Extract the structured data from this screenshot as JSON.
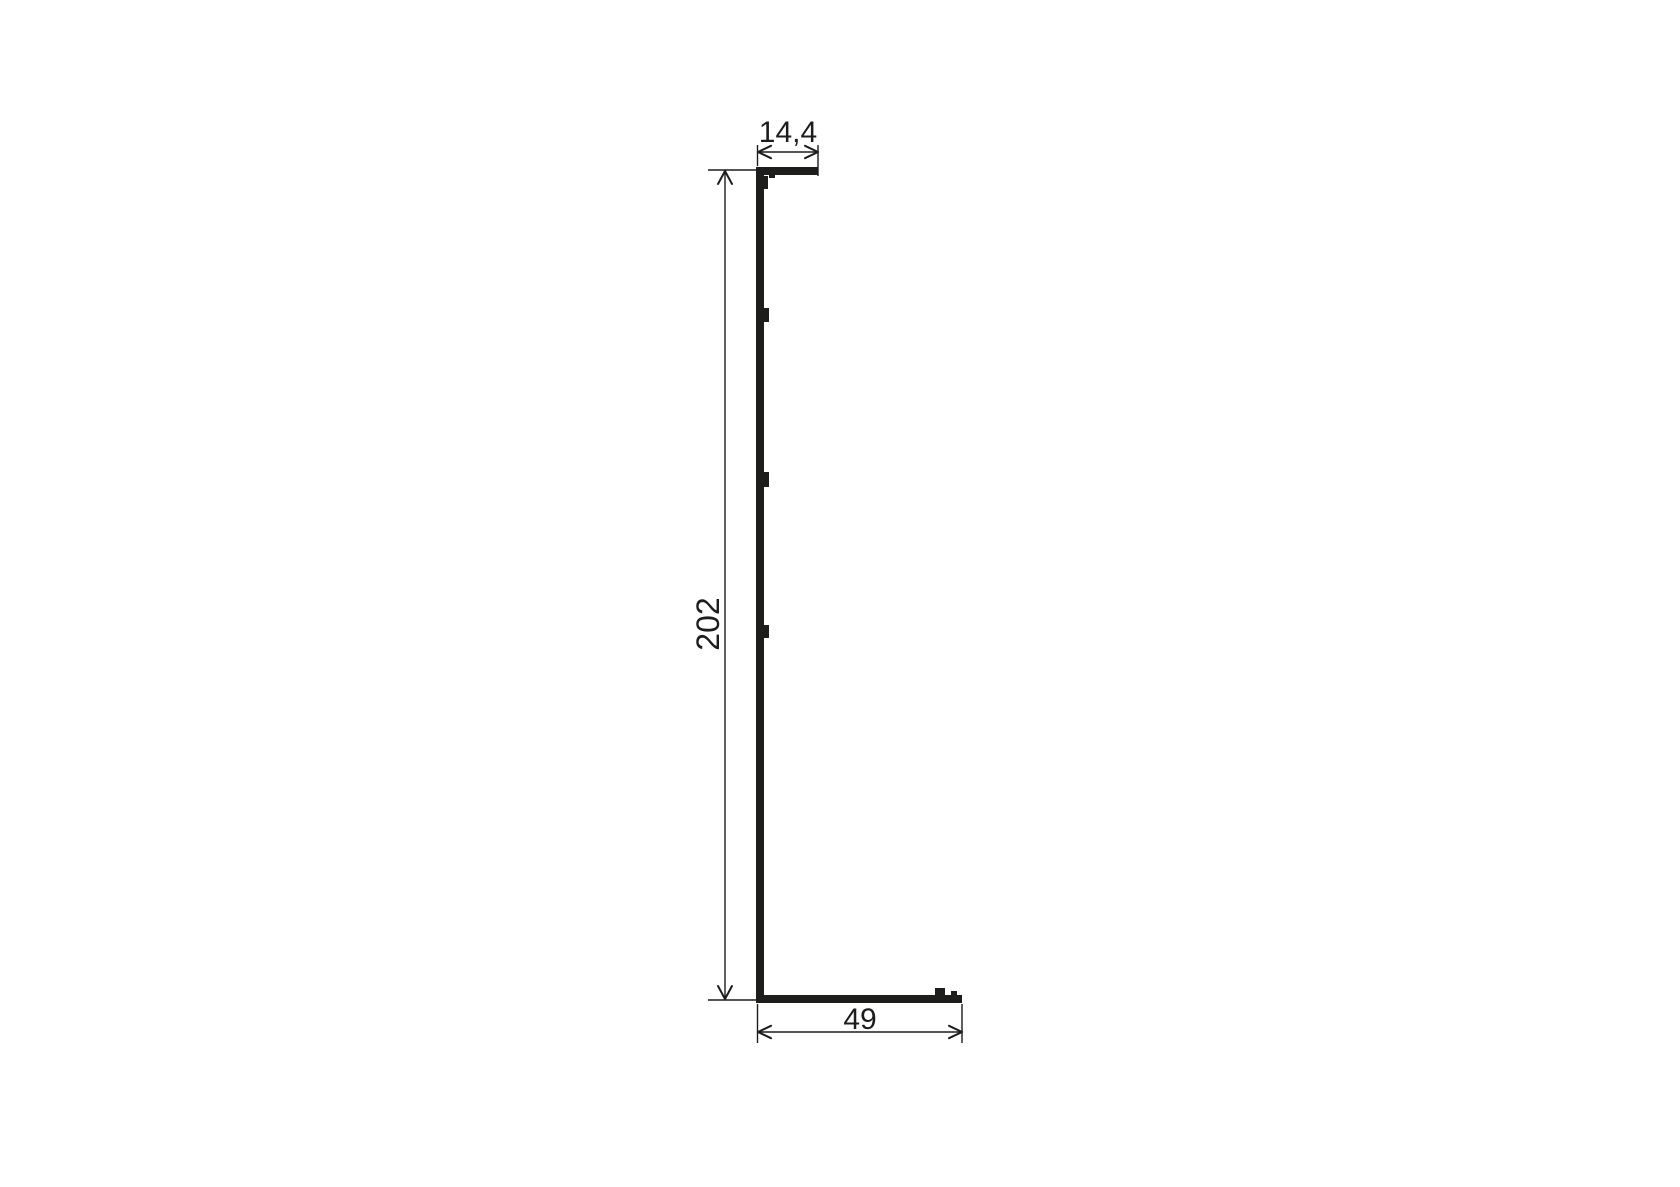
{
  "drawing": {
    "kind": "profile-cross-section",
    "colors": {
      "ink": "#1d1d1b",
      "background": "#ffffff"
    },
    "dimensions": {
      "top_width": "14,4",
      "height": "202",
      "bottom_width": "49"
    }
  }
}
